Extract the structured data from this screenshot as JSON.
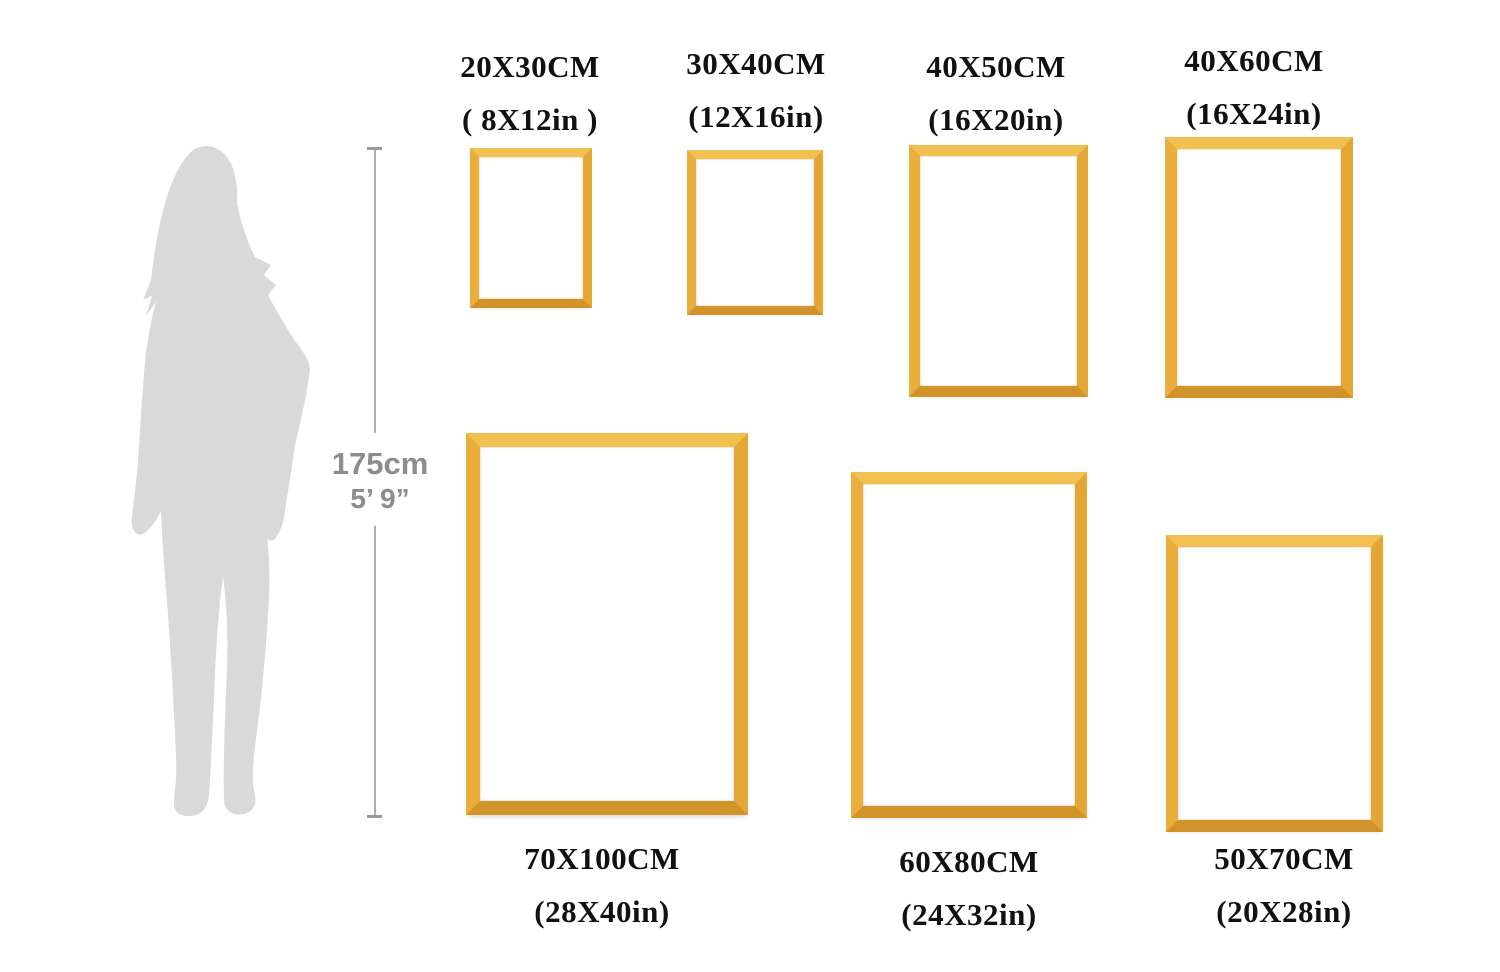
{
  "reference_figure": {
    "name": "woman-silhouette",
    "height_cm": "175cm",
    "height_ft": "5’ 9”",
    "silhouette_color": "#d9d9d9",
    "measure_line_color": "#adadad",
    "height_text_color": "#8c8c8c"
  },
  "frame_style": {
    "gold": "#e7a936",
    "gold_light": "#f2c050",
    "gold_dark": "#d2932a",
    "interior": "#ffffff"
  },
  "frames": [
    {
      "cm": "20X30CM",
      "inch": "( 8X12in )"
    },
    {
      "cm": "30X40CM",
      "inch": "(12X16in)"
    },
    {
      "cm": "40X50CM",
      "inch": "(16X20in)"
    },
    {
      "cm": "40X60CM",
      "inch": "(16X24in)"
    },
    {
      "cm": "70X100CM",
      "inch": "(28X40in)"
    },
    {
      "cm": "60X80CM",
      "inch": "(24X32in)"
    },
    {
      "cm": "50X70CM",
      "inch": "(20X28in)"
    }
  ]
}
